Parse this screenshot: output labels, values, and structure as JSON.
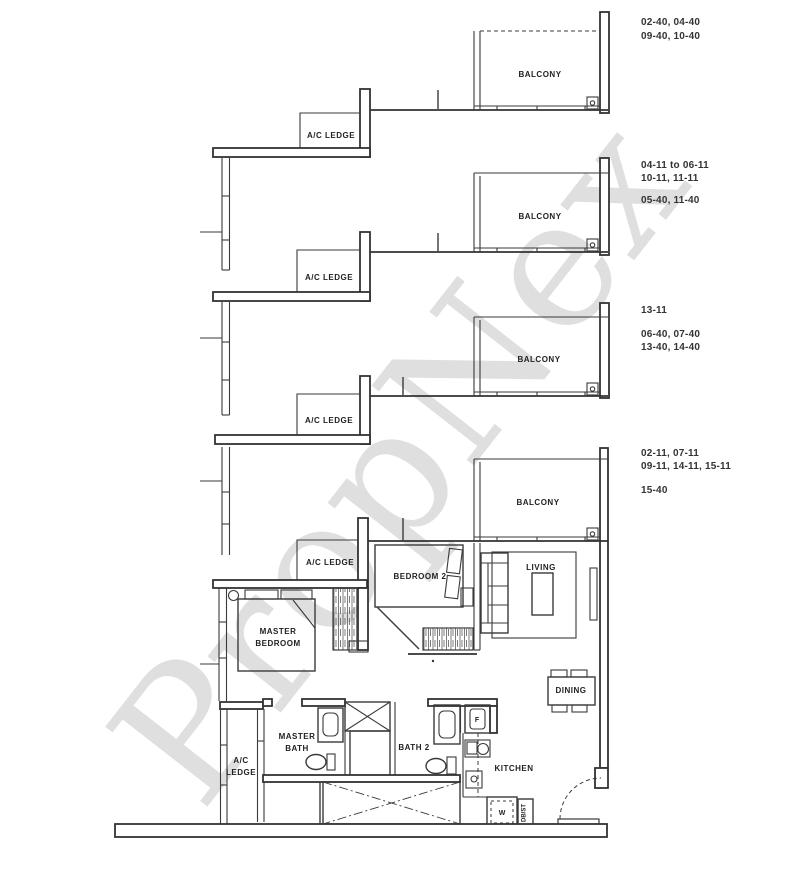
{
  "watermark": {
    "text": "PropNex"
  },
  "annotations": {
    "group1": {
      "line1": "02-40, 04-40",
      "line2": "09-40, 10-40"
    },
    "group2": {
      "line1": "04-11 to 06-11",
      "line2": "10-11, 11-11",
      "line3": "05-40, 11-40"
    },
    "group3": {
      "line1": "13-11",
      "line2": "06-40, 07-40",
      "line3": "13-40, 14-40"
    },
    "group4": {
      "line1": "02-11, 07-11",
      "line2": "09-11, 14-11, 15-11",
      "line3": "15-40"
    }
  },
  "plan": {
    "balcony": "BALCONY",
    "ac_ledge": "A/C LEDGE",
    "bedroom2": "BEDROOM 2",
    "living": "LIVING",
    "dining": "DINING",
    "kitchen": "KITCHEN",
    "bath2": "BATH 2",
    "master_line1": "MASTER",
    "master_line2": "BEDROOM",
    "master_bath_line1": "MASTER",
    "master_bath_line2": "BATH",
    "ac_ledge_line1": "A/C",
    "ac_ledge_line2": "LEDGE",
    "fridge": "F",
    "washer": "W",
    "db_st": "DB/ST"
  },
  "colors": {
    "line": "#333333",
    "text": "#222222",
    "watermark": "#b2b2b2"
  }
}
